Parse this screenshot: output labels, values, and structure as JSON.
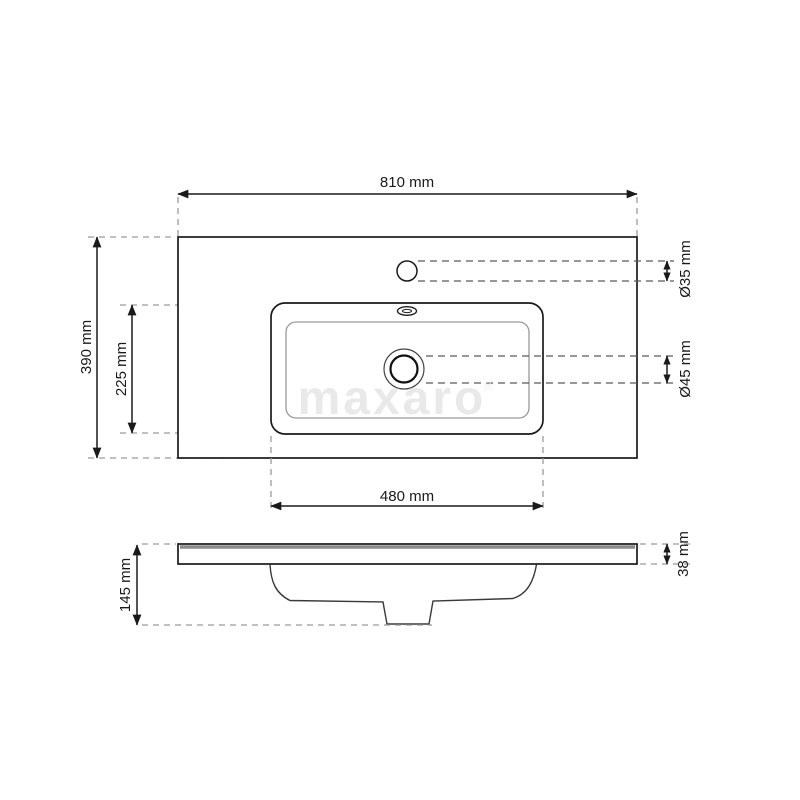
{
  "drawing": {
    "type": "washbasin-dimension-diagram",
    "watermark": {
      "text": "maxaro",
      "mark": "®",
      "color": "#e9e9e9"
    },
    "colors": {
      "line": "#1a1a1a",
      "extension_dash": "#9b9b9b",
      "leader_dash": "#5a5a5a",
      "slab_top_band": "#8a8a8a",
      "background": "#ffffff"
    },
    "top_view": {
      "dimensions": {
        "width": {
          "label": "810 mm",
          "value_mm": 810
        },
        "depth": {
          "label": "390 mm",
          "value_mm": 390
        },
        "basin_offset": {
          "label": "225 mm",
          "value_mm": 225
        },
        "basin_width": {
          "label": "480 mm",
          "value_mm": 480
        },
        "faucet_hole": {
          "label": "Ø35 mm",
          "value_mm": 35
        },
        "drain_hole": {
          "label": "Ø45 mm",
          "value_mm": 45
        }
      }
    },
    "side_view": {
      "dimensions": {
        "total_height": {
          "label": "145 mm",
          "value_mm": 145
        },
        "top_thickness": {
          "label": "38 mm",
          "value_mm": 38
        }
      }
    }
  }
}
